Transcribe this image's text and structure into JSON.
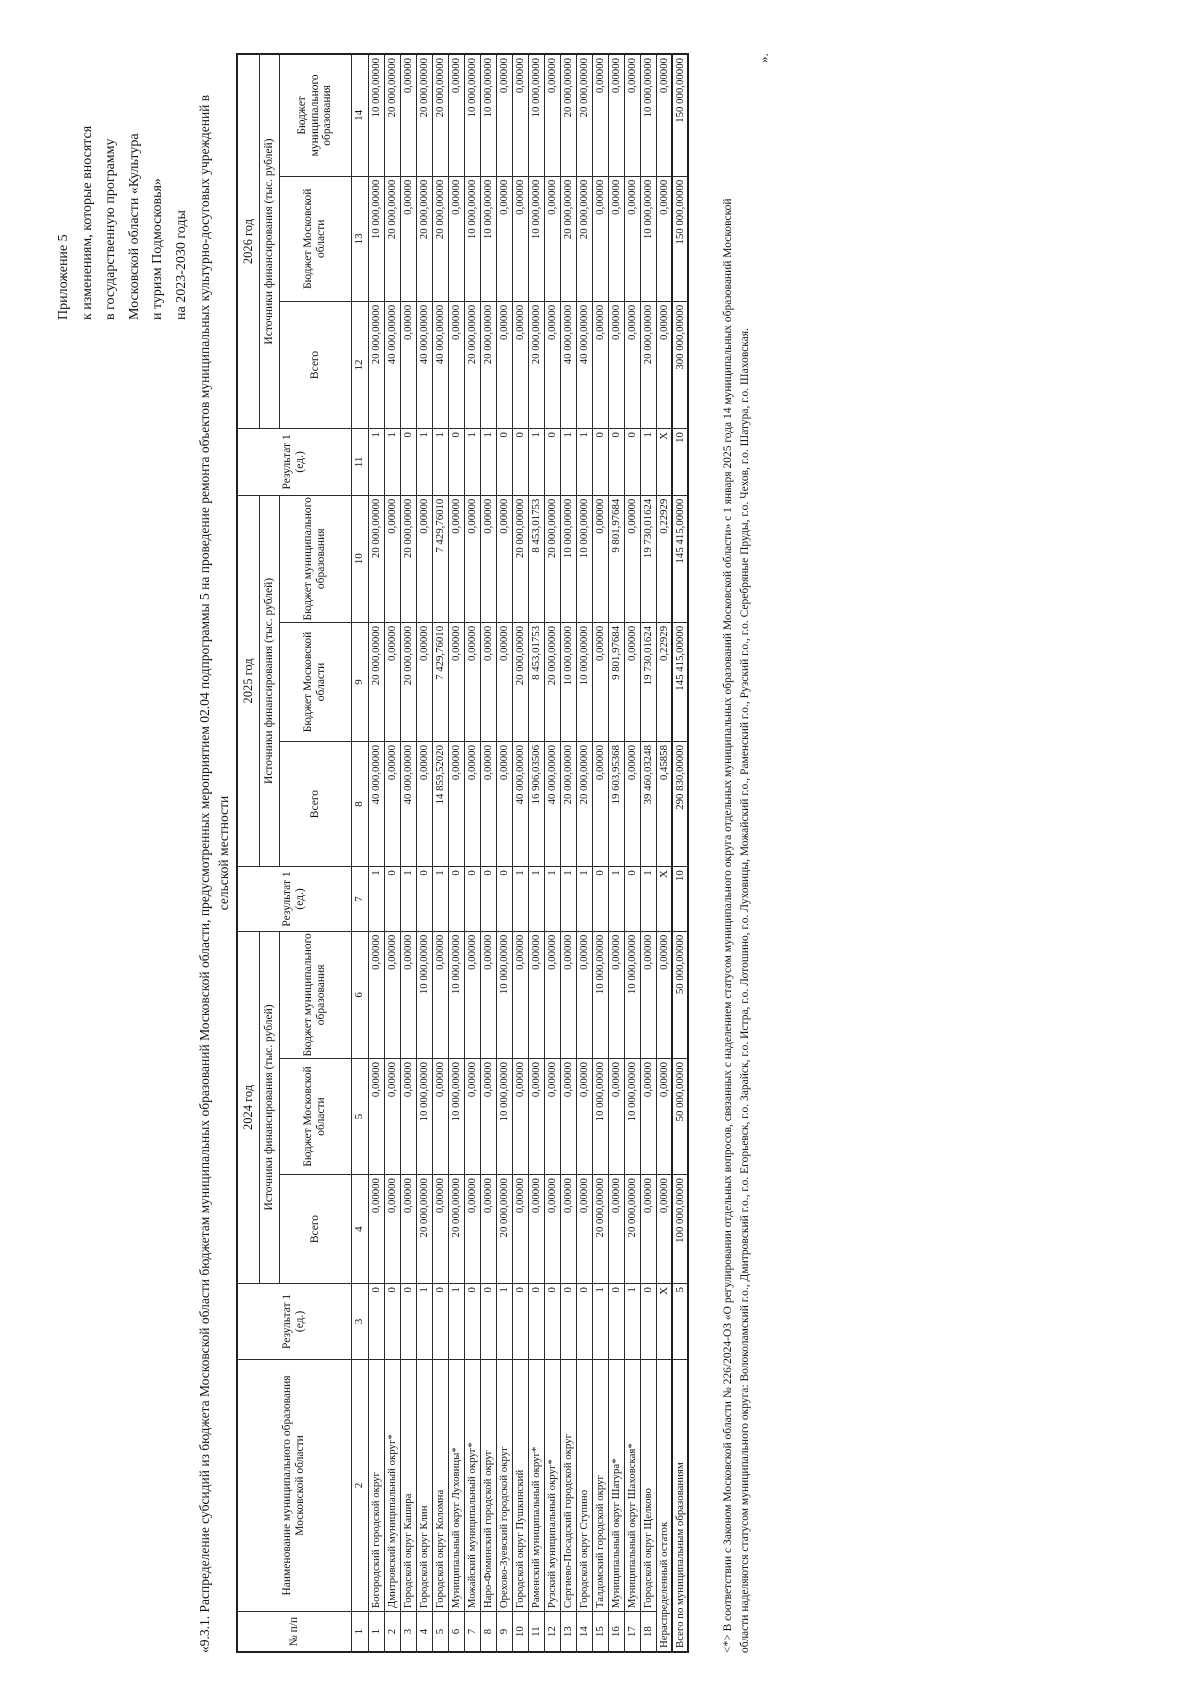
{
  "colors": {
    "ink": "#141414",
    "border": "#2b2b2b"
  },
  "appendix": {
    "lines": [
      "Приложение 5",
      "к изменениям, которые вносятся",
      "в государственную программу",
      "Московской области «Культура",
      "и туризм Подмосковья»",
      "на 2023-2030 годы"
    ]
  },
  "title": {
    "line1": "«9.3.1. Распределение субсидий из бюджета Московской области бюджетам муниципальных образований Московской области, предусмотренных мероприятием 02.04 подпрограммы 5 на проведение ремонта объектов муниципальных культурно-досуговых учреждений в",
    "line2": "сельской местности"
  },
  "closing_mark": "».",
  "footnote": {
    "line1": "<*> В соответствии с Законом Московской области № 226/2024-ОЗ «О регулировании отдельных вопросов, связанных с наделением статусом муниципального округа отдельных муниципальных образований Московской области» с 1 января 2025 года 14 муниципальных образований Московской",
    "line2": "области наделяются статусом муниципального округа: Волоколамский г.о., Дмитровский г.о., г.о. Егорьевск, г.о. Зарайск, г.о. Истра, г.о. Лотошино, г.о. Луховицы, Можайский г.о., Раменский г.о., Рузский г.о., г.о. Серебряные Пруды, г.о. Чехов, г.о. Шатура, г.о. Шаховская."
  },
  "table": {
    "headers": {
      "num": "№ п/п",
      "name": "Наименование муниципального образования Московской области",
      "result": "Результат 1 (ед.)",
      "sources": "Источники финансирования (тыс. рублей)",
      "total": "Всего",
      "budget_mo": "Бюджет Московской области",
      "budget_mun": "Бюджет муниципального образования",
      "years": [
        "2024 год",
        "2025 год",
        "2026 год"
      ],
      "col_numbers": [
        "1",
        "2",
        "3",
        "4",
        "5",
        "6",
        "7",
        "8",
        "9",
        "10",
        "11",
        "12",
        "13",
        "14"
      ]
    },
    "rows": [
      {
        "num": "1",
        "name": "Богородский городской округ",
        "c": [
          "0",
          "0,00000",
          "0,00000",
          "0,00000",
          "1",
          "40 000,00000",
          "20 000,00000",
          "20 000,00000",
          "1",
          "20 000,00000",
          "10 000,00000",
          "10 000,00000"
        ]
      },
      {
        "num": "2",
        "name": "Дмитровский муниципальный округ*",
        "c": [
          "0",
          "0,00000",
          "0,00000",
          "0,00000",
          "0",
          "0,00000",
          "0,00000",
          "0,00000",
          "1",
          "40 000,00000",
          "20 000,00000",
          "20 000,00000"
        ]
      },
      {
        "num": "3",
        "name": "Городской округ Кашира",
        "c": [
          "0",
          "0,00000",
          "0,00000",
          "0,00000",
          "1",
          "40 000,00000",
          "20 000,00000",
          "20 000,00000",
          "0",
          "0,00000",
          "0,00000",
          "0,00000"
        ]
      },
      {
        "num": "4",
        "name": "Городской округ Клин",
        "c": [
          "1",
          "20 000,00000",
          "10 000,00000",
          "10 000,00000",
          "0",
          "0,00000",
          "0,00000",
          "0,00000",
          "1",
          "40 000,00000",
          "20 000,00000",
          "20 000,00000"
        ]
      },
      {
        "num": "5",
        "name": "Городской округ Коломна",
        "c": [
          "0",
          "0,00000",
          "0,00000",
          "0,00000",
          "1",
          "14 859,52020",
          "7 429,76010",
          "7 429,76010",
          "1",
          "40 000,00000",
          "20 000,00000",
          "20 000,00000"
        ]
      },
      {
        "num": "6",
        "name": "Муниципальный округ Луховицы*",
        "c": [
          "1",
          "20 000,00000",
          "10 000,00000",
          "10 000,00000",
          "0",
          "0,00000",
          "0,00000",
          "0,00000",
          "0",
          "0,00000",
          "0,00000",
          "0,00000"
        ]
      },
      {
        "num": "7",
        "name": "Можайский муниципальный округ*",
        "c": [
          "0",
          "0,00000",
          "0,00000",
          "0,00000",
          "0",
          "0,00000",
          "0,00000",
          "0,00000",
          "1",
          "20 000,00000",
          "10 000,00000",
          "10 000,00000"
        ]
      },
      {
        "num": "8",
        "name": "Наро-Фоминский городской округ",
        "c": [
          "0",
          "0,00000",
          "0,00000",
          "0,00000",
          "0",
          "0,00000",
          "0,00000",
          "0,00000",
          "1",
          "20 000,00000",
          "10 000,00000",
          "10 000,00000"
        ]
      },
      {
        "num": "9",
        "name": "Орехово-Зуевский городской округ",
        "c": [
          "1",
          "20 000,00000",
          "10 000,00000",
          "10 000,00000",
          "0",
          "0,00000",
          "0,00000",
          "0,00000",
          "0",
          "0,00000",
          "0,00000",
          "0,00000"
        ]
      },
      {
        "num": "10",
        "name": "Городской округ Пушкинский",
        "c": [
          "0",
          "0,00000",
          "0,00000",
          "0,00000",
          "1",
          "40 000,00000",
          "20 000,00000",
          "20 000,00000",
          "0",
          "0,00000",
          "0,00000",
          "0,00000"
        ]
      },
      {
        "num": "11",
        "name": "Раменский муниципальный округ*",
        "c": [
          "0",
          "0,00000",
          "0,00000",
          "0,00000",
          "1",
          "16 906,03506",
          "8 453,01753",
          "8 453,01753",
          "1",
          "20 000,00000",
          "10 000,00000",
          "10 000,00000"
        ]
      },
      {
        "num": "12",
        "name": "Рузский муниципальный округ*",
        "c": [
          "0",
          "0,00000",
          "0,00000",
          "0,00000",
          "1",
          "40 000,00000",
          "20 000,00000",
          "20 000,00000",
          "0",
          "0,00000",
          "0,00000",
          "0,00000"
        ]
      },
      {
        "num": "13",
        "name": "Сергиево-Посадский городской округ",
        "c": [
          "0",
          "0,00000",
          "0,00000",
          "0,00000",
          "1",
          "20 000,00000",
          "10 000,00000",
          "10 000,00000",
          "1",
          "40 000,00000",
          "20 000,00000",
          "20 000,00000"
        ]
      },
      {
        "num": "14",
        "name": "Городской округ Ступино",
        "c": [
          "0",
          "0,00000",
          "0,00000",
          "0,00000",
          "1",
          "20 000,00000",
          "10 000,00000",
          "10 000,00000",
          "1",
          "40 000,00000",
          "20 000,00000",
          "20 000,00000"
        ]
      },
      {
        "num": "15",
        "name": "Талдомский городской округ",
        "c": [
          "1",
          "20 000,00000",
          "10 000,00000",
          "10 000,00000",
          "0",
          "0,00000",
          "0,00000",
          "0,00000",
          "0",
          "0,00000",
          "0,00000",
          "0,00000"
        ]
      },
      {
        "num": "16",
        "name": "Муниципальный округ Шатура*",
        "c": [
          "0",
          "0,00000",
          "0,00000",
          "0,00000",
          "1",
          "19 603,95368",
          "9 801,97684",
          "9 801,97684",
          "0",
          "0,00000",
          "0,00000",
          "0,00000"
        ]
      },
      {
        "num": "17",
        "name": "Муниципальный округ Шаховская*",
        "c": [
          "1",
          "20 000,00000",
          "10 000,00000",
          "10 000,00000",
          "0",
          "0,00000",
          "0,00000",
          "0,00000",
          "0",
          "0,00000",
          "0,00000",
          "0,00000"
        ]
      },
      {
        "num": "18",
        "name": "Городской округ Щелково",
        "c": [
          "0",
          "0,00000",
          "0,00000",
          "0,00000",
          "1",
          "39 460,03248",
          "19 730,01624",
          "19 730,01624",
          "1",
          "20 000,00000",
          "10 000,00000",
          "10 000,00000"
        ]
      },
      {
        "name": "Нераспределенный остаток",
        "merged": true,
        "c": [
          "X",
          "0,00000",
          "0,00000",
          "0,00000",
          "X",
          "0,45858",
          "0,22929",
          "0,22929",
          "X",
          "0,00000",
          "0,00000",
          "0,00000"
        ]
      },
      {
        "name": "Всего по муниципальным образованиям",
        "merged": true,
        "total": true,
        "c": [
          "5",
          "100 000,00000",
          "50 000,00000",
          "50 000,00000",
          "10",
          "290 830,00000",
          "145 415,00000",
          "145 415,00000",
          "10",
          "300 000,00000",
          "150 000,00000",
          "150 000,00000"
        ]
      }
    ]
  }
}
